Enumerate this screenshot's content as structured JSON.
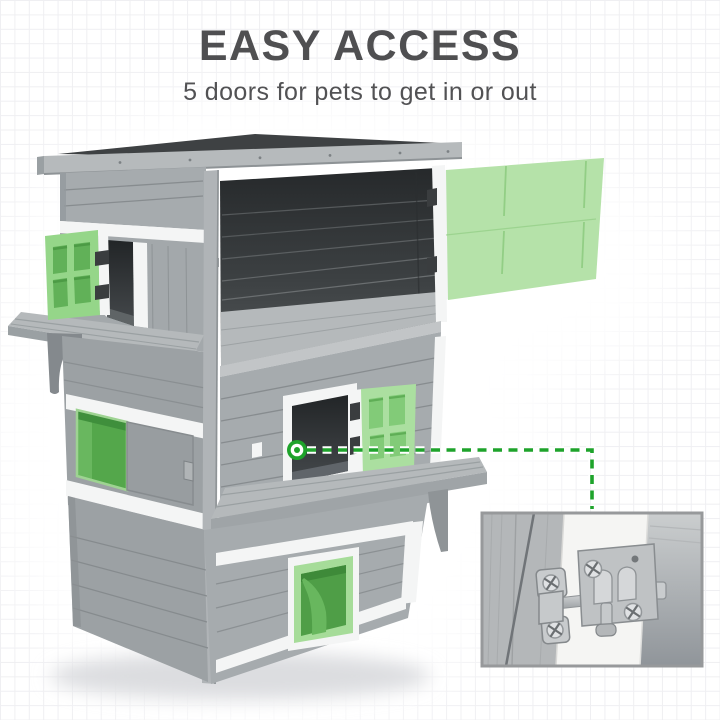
{
  "header": {
    "title": "EASY ACCESS",
    "subtitle": "5 doors for pets to get in or out"
  },
  "figure": {
    "subject": "three-tier gray wooden cat house with five green pet doors",
    "callout_detail": "slide-bolt door latch close-up"
  },
  "palette": {
    "paper": "#ffffff",
    "grid": "#efeff2",
    "ink": "#4f4f51",
    "ink_soft": "#525254",
    "roof": "#3e4143",
    "fascia": "#b6babc",
    "wood": "#a6abae",
    "wood_dark": "#9ca1a4",
    "groove": "#878c8f",
    "floor": "#b5b9bb",
    "trim": "#f4f5f5",
    "post": "#b0b4b7",
    "green_door": "#b5e2a9",
    "green_seam": "#92ce85",
    "green_frame": "#95d689",
    "green_pane": "#61b158",
    "green_pane_dark": "#4c9b45",
    "green_open": "#54a74b",
    "green_tunnel_frame": "#a6dc99",
    "green_tunnel": "#4f9e47",
    "callout_green": "#1ea32b",
    "inset_border": "#97999b",
    "steel": "#c8cbcd",
    "steel_light": "#e0e2e4"
  }
}
